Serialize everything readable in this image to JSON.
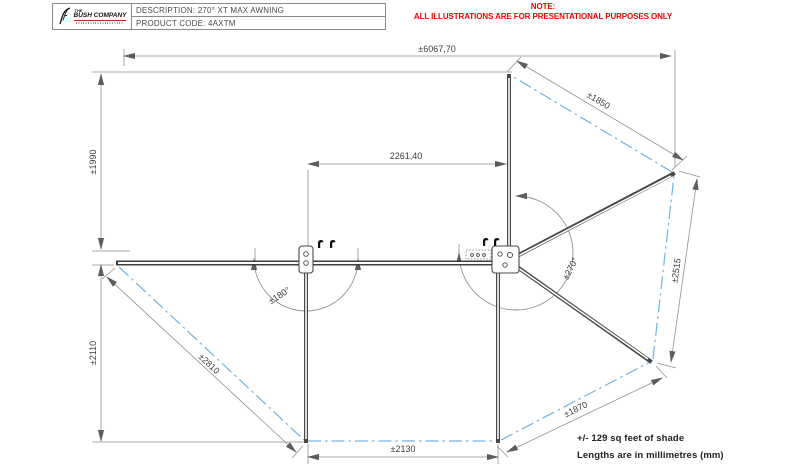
{
  "title_block": {
    "description": "DESCRIPTION: 270° XT MAX AWNING",
    "product_code": "PRODUCT CODE: 4AXTM",
    "brand": {
      "the": "THE",
      "name": "BUSH COMPANY"
    }
  },
  "note": {
    "heading": "NOTE:",
    "line": "ALL ILLUSTRATIONS ARE FOR PRESENTATIONAL PURPOSES ONLY"
  },
  "dims": {
    "overall_width": "±6067,70",
    "upper_left_height": "±1990",
    "rail_length": "2261,40",
    "top_right_edge": "±1850",
    "right_edge": "±2515",
    "sweep_right": "±270°",
    "sweep_left": "±180°",
    "lower_left_height": "±2110",
    "left_wing_edge": "±2810",
    "bottom_right_edge": "±1870",
    "bottom_edge": "±2130"
  },
  "footnotes": {
    "shade": "+/- 129 sq feet of shade",
    "units": "Lengths are in millimetres (mm)"
  },
  "colors": {
    "geometry_line": "#474747",
    "dimension_line": "#8f8f8f",
    "fabric_edge": "#72b2e6",
    "note_red": "#ff0000",
    "brand_red": "#cf1d1d"
  }
}
